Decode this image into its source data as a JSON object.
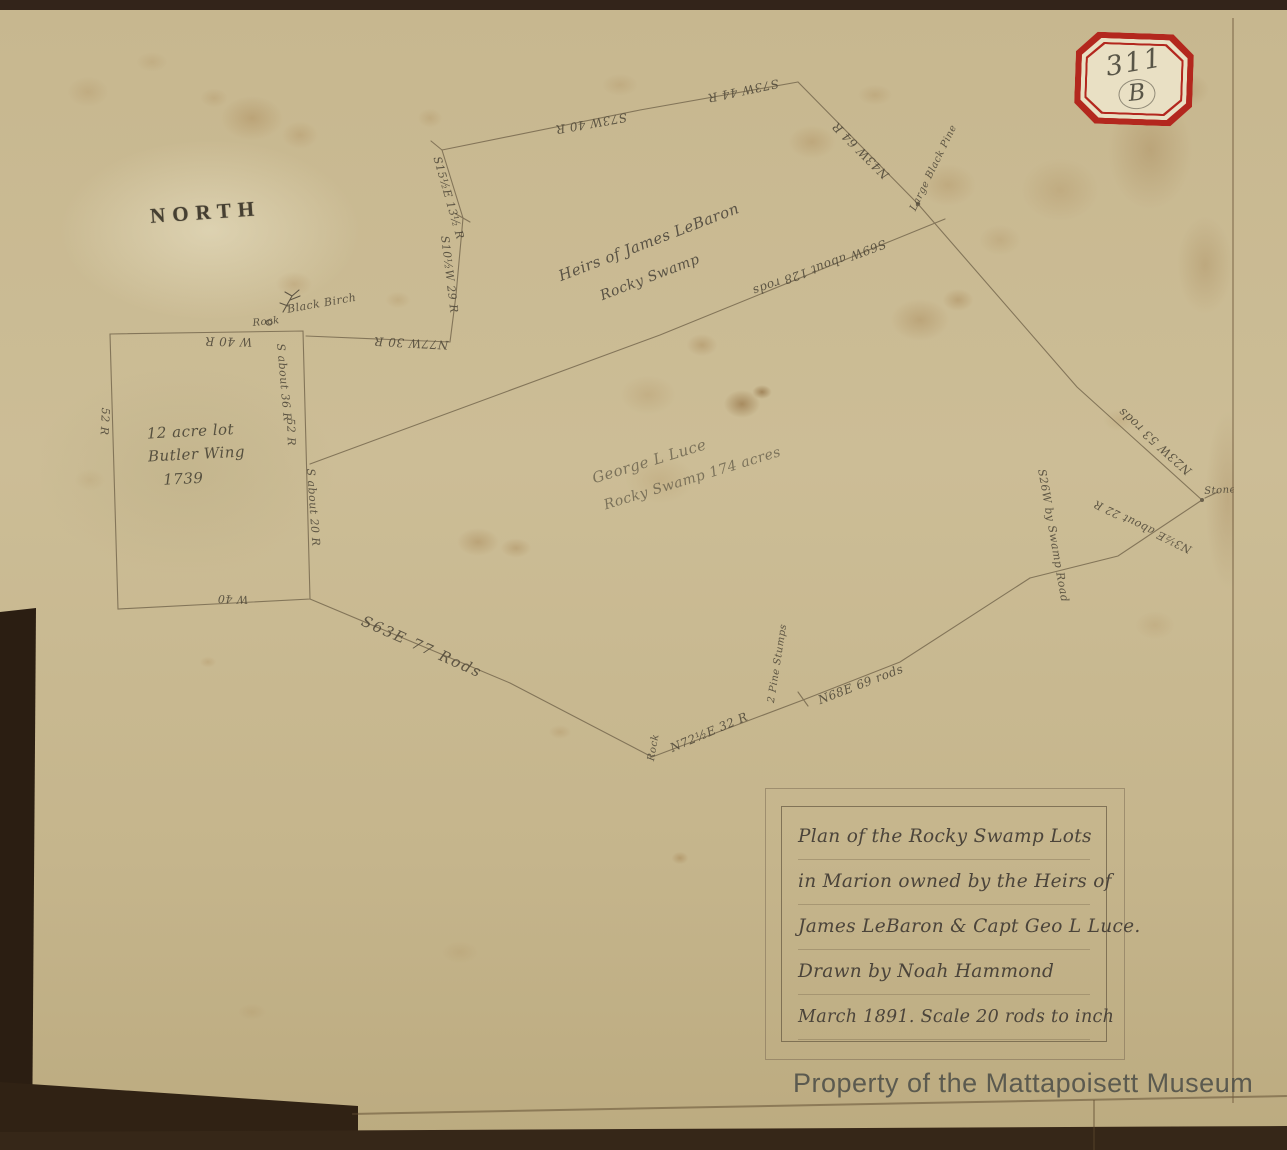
{
  "stamp": {
    "number": "311",
    "letter": "B"
  },
  "compass": {
    "north_label": "NORTH"
  },
  "parcels": {
    "butler": {
      "line1": "12 acre lot",
      "line2": "Butler Wing",
      "line3": "1739"
    },
    "lebaron": {
      "line1": "Heirs of James LeBaron",
      "line2": "Rocky Swamp"
    },
    "luce": {
      "line1": "George L Luce",
      "line2": "Rocky Swamp 174 acres"
    }
  },
  "labels": {
    "s73w_40": "S73W 40 R",
    "s73w_44": "S73W 44 R",
    "s15e": "S15½E 13½ R",
    "s10w": "S10½W 29 R",
    "rock_small": "Rock",
    "black_birch": "Black Birch",
    "n77w": "N77W 30 R",
    "w40r": "W 40 R",
    "w52r_left": "52 R",
    "s_about_36": "S about 36 R",
    "r52_mid": "52 R",
    "s_about_20": "S about 20 R",
    "w40_bottom": "W 40",
    "s63e": "S63E  77 Rods",
    "rock_bottom": "Rock",
    "n72e": "N72½E 32 R",
    "pine_stumps": "2 Pine Stumps",
    "n68e": "N68E 69 rods",
    "s69w": "S69W about 128 rods",
    "n43w": "N43W 64 R",
    "large_black_pine": "Large Black Pine",
    "n23w": "N23W 53 rods",
    "stone": "Stone",
    "n3e": "N3½E about 22 R",
    "s26w": "S26W by Swamp Road"
  },
  "title_box": {
    "lines": [
      "Plan of the Rocky Swamp Lots",
      "in Marion owned by the Heirs of",
      "James LeBaron & Capt Geo L Luce.",
      "Drawn by Noah Hammond",
      "March 1891.  Scale 20 rods to inch"
    ]
  },
  "watermark": "Property of the Mattapoisett Museum",
  "colors": {
    "stamp_red": "#b3271e",
    "ink": "#4f4839",
    "survey_line": "#77694f",
    "sheet": "#e6dec3",
    "album_page": "#c7b78f",
    "photo_border": "#33241a",
    "watermark_gray": "#53534b"
  }
}
